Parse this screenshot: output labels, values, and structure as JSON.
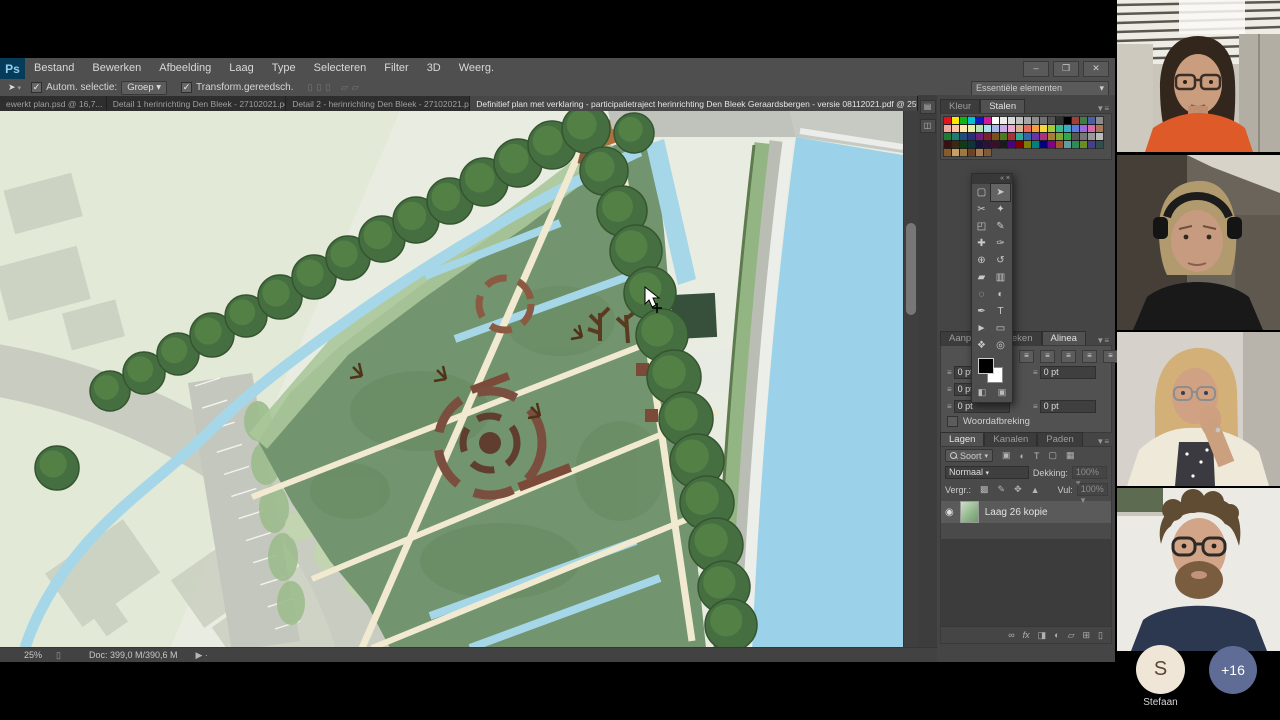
{
  "colors": {
    "ps_chrome": "#4f4f4f",
    "canvas_water": "#9cd1ea",
    "park_green": "#72946f",
    "avatar_bg": "#f0e6d7",
    "badge_bg": "#5f6c96",
    "ps_logo_bg": "#063c59"
  },
  "menu_bar": {
    "logo": "Ps",
    "items": [
      "Bestand",
      "Bewerken",
      "Afbeelding",
      "Laag",
      "Type",
      "Selecteren",
      "Filter",
      "3D",
      "Weerg."
    ],
    "window_controls": [
      "–",
      "❐",
      "✕"
    ]
  },
  "options_bar": {
    "move_icon": "➤",
    "auto_select_label": "Autom. selectie:",
    "group_value": "Groep",
    "transform_label": "Transform.gereedsch.",
    "workspace": "Essentiële elementen"
  },
  "document_tabs": [
    {
      "title": "ewerkt plan.psd @ 16,7...",
      "close": "×",
      "active": false
    },
    {
      "title": "Detail 1 herinrichting Den Bleek - 27102021.pdf",
      "close": "×",
      "active": false
    },
    {
      "title": "Detail 2 - herinrichting Den Bleek - 27102021.pdf",
      "close": "×",
      "active": false
    },
    {
      "title": "Definitief plan met verklaring - participatietraject herinrichting Den Bleek Geraardsbergen - versie 08112021.pdf @ 25% (RGB/8)",
      "close": "×",
      "active": true
    }
  ],
  "tab_overflow": "»",
  "swatches_panel": {
    "tabs": [
      "Kleur",
      "Stalen"
    ],
    "active_tab": "Stalen",
    "rows": [
      [
        "#e3121b",
        "#ffe800",
        "#0db515",
        "#00c2d6",
        "#1117c4",
        "#d5179b",
        "#ffffff",
        "#ececec",
        "#d9d9d9",
        "#c0c0c0",
        "#a6a6a6",
        "#8c8c8c",
        "#707070",
        "#525252",
        "#303030",
        "#000000",
        "#a33f3a",
        "#3f7d45",
        "#4a5fa5",
        "#8a8a8a"
      ],
      [
        "#f2a7a0",
        "#f7c6a4",
        "#fbe7a9",
        "#e4f0a8",
        "#b7e3b4",
        "#aadeea",
        "#a9b6e8",
        "#c9a8e6",
        "#eaa8d2",
        "#d8b28f",
        "#e86a5e",
        "#f0a03c",
        "#f5d83c",
        "#a8c83c",
        "#3cb88a",
        "#3ca8c8",
        "#5c78d8",
        "#9a6ad8",
        "#d86aa8",
        "#a87858"
      ],
      [
        "#207a33",
        "#1f7a72",
        "#1f4e7a",
        "#2d2d7a",
        "#6a1f7a",
        "#7a1f2d",
        "#7a4e1f",
        "#4e7a1f",
        "#a8323a",
        "#32a89b",
        "#3267a8",
        "#6a32a8",
        "#a8327f",
        "#a87f32",
        "#7fa832",
        "#32a84e",
        "#555555",
        "#777777",
        "#999999",
        "#bbbbbb"
      ],
      [
        "#3a0f0f",
        "#3a2a0f",
        "#0f3a14",
        "#0f333a",
        "#14143a",
        "#2e0f3a",
        "#3a0f2a",
        "#1a1a1a",
        "#4b0082",
        "#800000",
        "#808000",
        "#008080",
        "#000080",
        "#800080",
        "#a0522d",
        "#5f9ea0",
        "#2e8b57",
        "#6b8e23",
        "#483d8b",
        "#2f4f4f"
      ],
      [
        "#8a5a2a",
        "#c9a063",
        "#9c7a3e",
        "#6b4423",
        "#a67c52",
        "#7d5a3a"
      ]
    ]
  },
  "toolbar": {
    "tools": [
      {
        "name": "rectangular-marquee-tool",
        "glyph": "▢",
        "selected": false
      },
      {
        "name": "move-tool",
        "glyph": "➤",
        "selected": true
      },
      {
        "name": "lasso-tool",
        "glyph": "✂",
        "selected": false
      },
      {
        "name": "quick-selection-tool",
        "glyph": "✦",
        "selected": false
      },
      {
        "name": "crop-tool",
        "glyph": "◰",
        "selected": false
      },
      {
        "name": "eyedropper-tool",
        "glyph": "✎",
        "selected": false
      },
      {
        "name": "healing-brush-tool",
        "glyph": "✚",
        "selected": false
      },
      {
        "name": "brush-tool",
        "glyph": "✑",
        "selected": false
      },
      {
        "name": "clone-stamp-tool",
        "glyph": "⊕",
        "selected": false
      },
      {
        "name": "history-brush-tool",
        "glyph": "↺",
        "selected": false
      },
      {
        "name": "eraser-tool",
        "glyph": "▰",
        "selected": false
      },
      {
        "name": "gradient-tool",
        "glyph": "▥",
        "selected": false
      },
      {
        "name": "blur-tool",
        "glyph": "◌",
        "selected": false
      },
      {
        "name": "dodge-tool",
        "glyph": "◐",
        "selected": false
      },
      {
        "name": "pen-tool",
        "glyph": "✒",
        "selected": false
      },
      {
        "name": "type-tool",
        "glyph": "T",
        "selected": false
      },
      {
        "name": "path-selection-tool",
        "glyph": "►",
        "selected": false
      },
      {
        "name": "shape-tool",
        "glyph": "▭",
        "selected": false
      },
      {
        "name": "hand-tool",
        "glyph": "❖",
        "selected": false
      },
      {
        "name": "zoom-tool",
        "glyph": "◎",
        "selected": false
      }
    ]
  },
  "paragraph_panel": {
    "tabs": [
      "Aanpas...",
      "Teken",
      "Alinea"
    ],
    "active_tab": "Alinea",
    "align_glyph": "≡",
    "fields": [
      {
        "v": "0 pt"
      },
      {
        "v": "0 pt"
      },
      {
        "v": "0 pt"
      },
      {
        "v": "0 pt"
      },
      {
        "v": "0 pt"
      }
    ],
    "hyphenation_label": "Woordafbreking"
  },
  "layers_panel": {
    "tabs": [
      "Lagen",
      "Kanalen",
      "Paden"
    ],
    "active_tab": "Lagen",
    "filter_label": "Soort",
    "blend_mode": "Normaal",
    "opacity_label": "Dekking:",
    "opacity_value": "100%",
    "lock_label": "Vergr.:",
    "fill_label": "Vul:",
    "fill_value": "100%",
    "layer": {
      "name": "Laag 26 kopie",
      "eye": "◉"
    }
  },
  "status_bar": {
    "zoom_level": "25%",
    "doc_info": "Doc: 399,0 M/390,6 M"
  },
  "meeting_panel": {
    "participant_count": 4,
    "overflow_avatar": {
      "initial": "S",
      "name": "Stefaan"
    },
    "more_badge": "+16"
  }
}
